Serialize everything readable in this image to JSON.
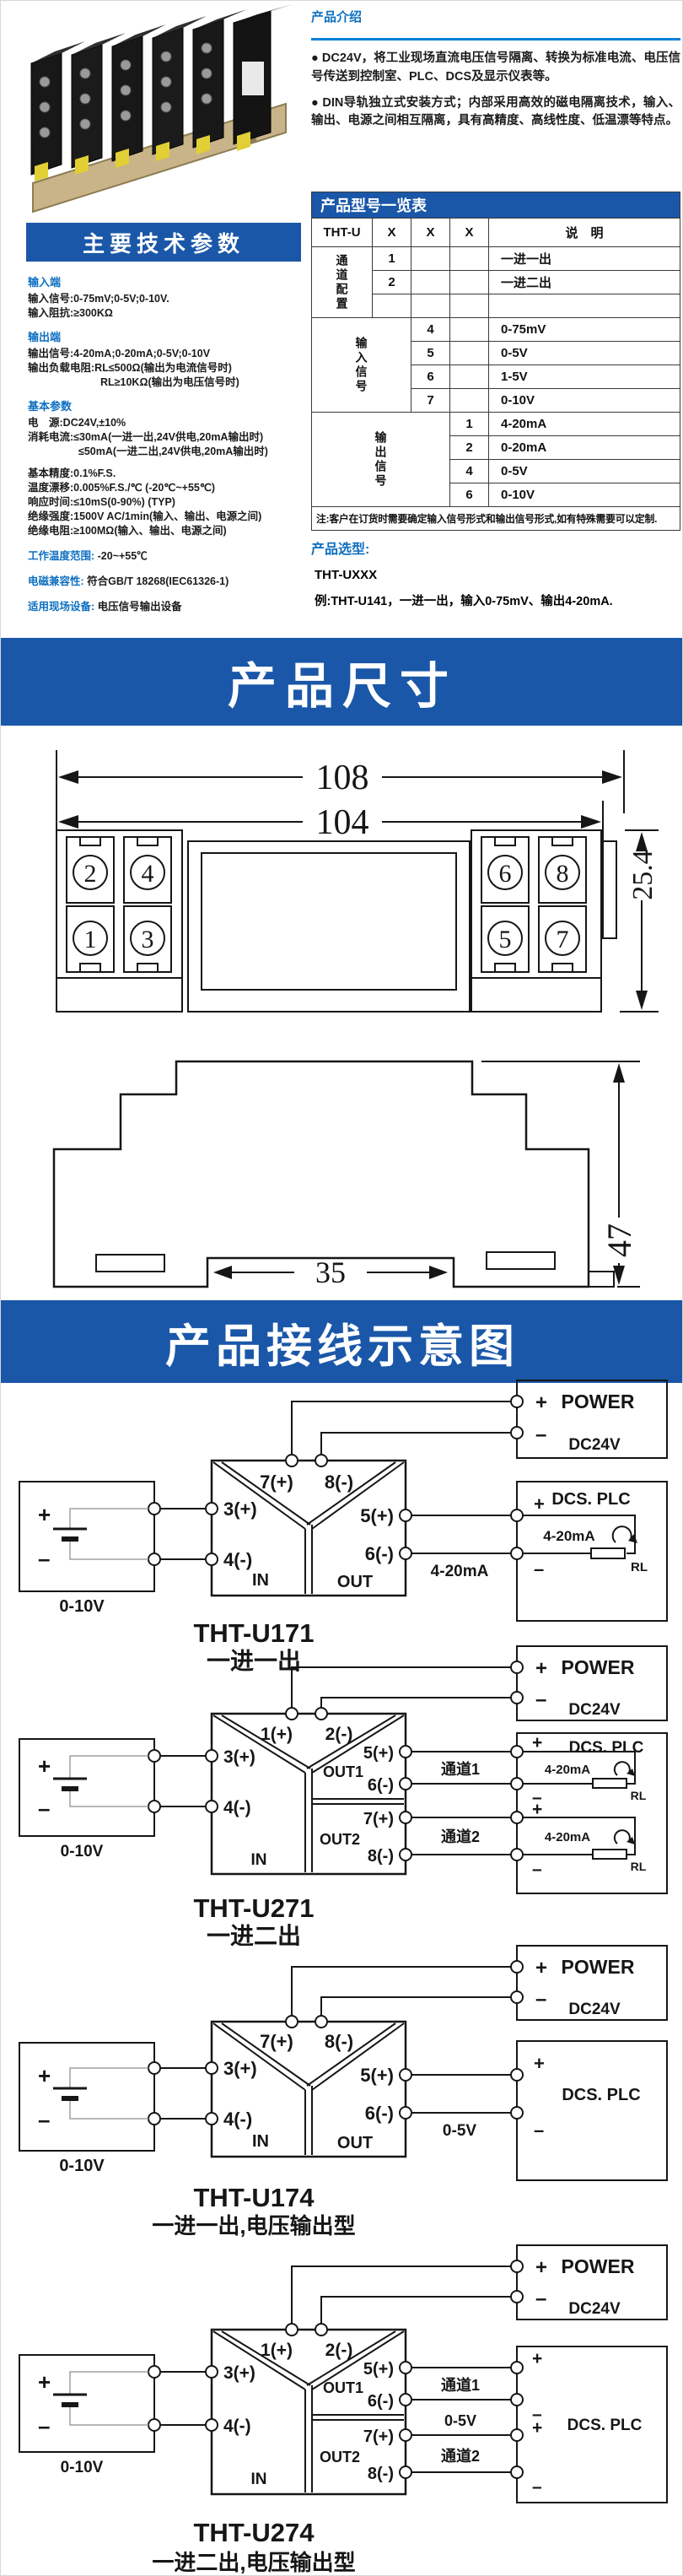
{
  "colors": {
    "banner_blue": "#1a57a8",
    "heading_blue": "#0d6fc0",
    "rule_blue": "#0b82dc"
  },
  "intro": {
    "title": "产品介绍",
    "bullets": [
      "● DC24V，将工业现场直流电压信号隔离、转换为标准电流、电压信号传送到控制室、PLC、DCS及显示仪表等。",
      "● DIN导轨独立式安装方式；内部采用高效的磁电隔离技术，输入、输出、电源之间相互隔离，具有高精度、高线性度、低温漂等特点。"
    ]
  },
  "model_table": {
    "title": "产品型号一览表",
    "prefix": "THT-U",
    "x1": "X",
    "x2": "X",
    "x3": "X",
    "desc_head": "说　明",
    "g1_label": "通道配置",
    "g1": [
      {
        "c": "1",
        "d": "一进一出"
      },
      {
        "c": "2",
        "d": "一进二出"
      },
      {
        "c": "",
        "d": ""
      }
    ],
    "g2_label": "输入信号",
    "g2": [
      {
        "c": "4",
        "d": "0-75mV"
      },
      {
        "c": "5",
        "d": "0-5V"
      },
      {
        "c": "6",
        "d": "1-5V"
      },
      {
        "c": "7",
        "d": "0-10V"
      }
    ],
    "g3_label": "输出信号",
    "g3": [
      {
        "c": "1",
        "d": "4-20mA"
      },
      {
        "c": "2",
        "d": "0-20mA"
      },
      {
        "c": "4",
        "d": "0-5V"
      },
      {
        "c": "6",
        "d": "0-10V"
      }
    ],
    "note": "注:客户在订货时需要确定输入信号形式和输出信号形式,如有特殊需要可以定制."
  },
  "selection": {
    "title": "产品选型:",
    "model": "THT-UXXX",
    "example": "例:THT-U141，一进一出，输入0-75mV、输出4-20mA."
  },
  "specs": {
    "banner": "主要技术参数",
    "s1_head": "输入端",
    "s1_lines": [
      "输入信号:0-75mV;0-5V;0-10V.",
      "输入阻抗:≥300KΩ"
    ],
    "s2_head": "输出端",
    "s2_lines": [
      "输出信号:4-20mA;0-20mA;0-5V;0-10V",
      "输出负载电阻:RL≤500Ω(输出为电流信号时)",
      "RL≥10KΩ(输出为电压信号时)"
    ],
    "s3_head": "基本参数",
    "s3_lines": [
      "电　源:DC24V,±10%",
      "消耗电流:≤30mA(一进一出,24V供电,20mA输出时)",
      "≤50mA(一进二出,24V供电,20mA输出时)"
    ],
    "s3b_lines": [
      "基本精度:0.1%F.S.",
      "温度漂移:0.005%F.S./℃ (-20℃~+55℃)",
      "响应时间:≤10mS(0-90%) (TYP)",
      "绝缘强度:1500V AC/1min(输入、输出、电源之间)",
      "绝缘电阻:≥100MΩ(输入、输出、电源之间)"
    ],
    "kv": [
      {
        "k": "工作温度范围:",
        "v": " -20~+55℃"
      },
      {
        "k": "电磁兼容性:",
        "v": " 符合GB/T 18268(IEC61326-1)"
      },
      {
        "k": "适用现场设备:",
        "v": " 电压信号输出设备"
      }
    ]
  },
  "banners": {
    "dimensions": "产品尺寸",
    "wiring": "产品接线示意图"
  },
  "dimension_figure": {
    "outer_width": "108",
    "inner_width": "104",
    "depth": "25.4",
    "height": "47",
    "rail_width": "35",
    "terminals": {
      "tl": [
        "2",
        "4",
        "1",
        "3"
      ],
      "tr": [
        "6",
        "8",
        "5",
        "7"
      ]
    }
  },
  "symbols": {
    "plus": "+",
    "minus": "–"
  },
  "diagrams": [
    {
      "model": "THT-U171",
      "subtitle": "一进一出",
      "power": "POWER",
      "voltage": "DC24V",
      "source": "0-10V",
      "in": "IN",
      "out": "OUT",
      "t_top_a": "7(+)",
      "t_top_b": "8(-)",
      "t_in_a": "3(+)",
      "t_in_b": "4(-)",
      "t_out_a": "5(+)",
      "t_out_b": "6(-)",
      "wire": "4-20mA",
      "dcs": "DCS. PLC",
      "loop": "4-20mA",
      "rl": "RL"
    },
    {
      "model": "THT-U271",
      "subtitle": "一进二出",
      "power": "POWER",
      "voltage": "DC24V",
      "source": "0-10V",
      "in": "IN",
      "out1": "OUT1",
      "out2": "OUT2",
      "t_top_a": "1(+)",
      "t_top_b": "2(-)",
      "t_in_a": "3(+)",
      "t_in_b": "4(-)",
      "t_out1_a": "5(+)",
      "t_out1_b": "6(-)",
      "t_out2_a": "7(+)",
      "t_out2_b": "8(-)",
      "ch1": "通道1",
      "ch2": "通道2",
      "dcs": "DCS. PLC",
      "loop": "4-20mA",
      "rl": "RL"
    },
    {
      "model": "THT-U174",
      "subtitle": "一进一出,电压输出型",
      "power": "POWER",
      "voltage": "DC24V",
      "source": "0-10V",
      "in": "IN",
      "out": "OUT",
      "t_top_a": "7(+)",
      "t_top_b": "8(-)",
      "t_in_a": "3(+)",
      "t_in_b": "4(-)",
      "t_out_a": "5(+)",
      "t_out_b": "6(-)",
      "wire": "0-5V",
      "dcs": "DCS. PLC"
    },
    {
      "model": "THT-U274",
      "subtitle": "一进二出,电压输出型",
      "power": "POWER",
      "voltage": "DC24V",
      "source": "0-10V",
      "in": "IN",
      "out1": "OUT1",
      "out2": "OUT2",
      "t_top_a": "1(+)",
      "t_top_b": "2(-)",
      "t_in_a": "3(+)",
      "t_in_b": "4(-)",
      "t_out1_a": "5(+)",
      "t_out1_b": "6(-)",
      "t_out2_a": "7(+)",
      "t_out2_b": "8(-)",
      "ch1": "通道1",
      "mid": "0-5V",
      "ch2": "通道2",
      "dcs": "DCS. PLC"
    }
  ]
}
